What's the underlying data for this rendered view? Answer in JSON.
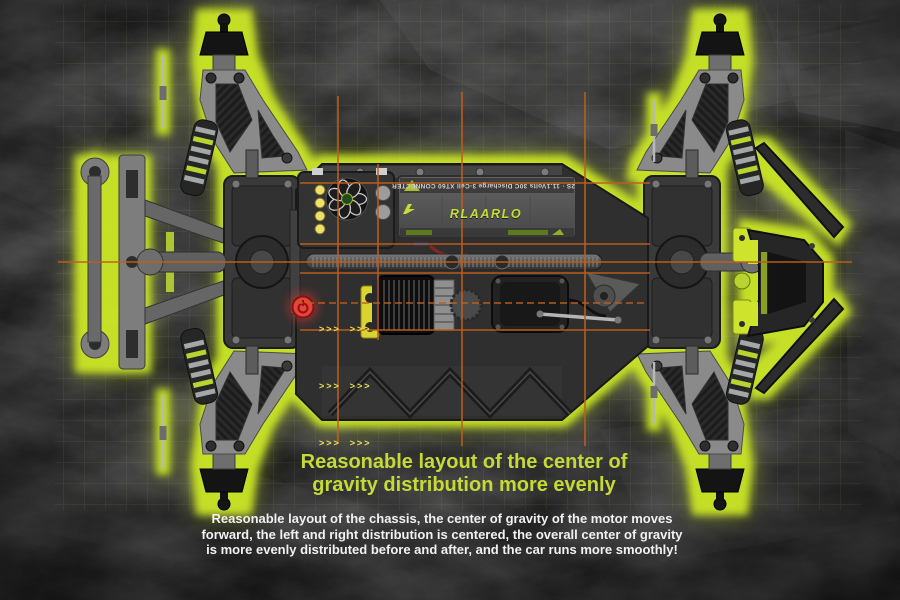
{
  "heading": {
    "line1": "Reasonable layout of the center of",
    "line2": "gravity distribution more evenly"
  },
  "body": {
    "line1": "Reasonable layout of the chassis, the center of gravity of the motor moves",
    "line2": "forward, the left and right distribution is centered, the overall center of gravity",
    "line3": "is more evenly distributed before and after, and the car runs more smoothly!"
  },
  "chassis": {
    "battery_brand": "RLAARLO",
    "battery_spec": "2S · 11.1Volts 30C Discharge 3-Cell XT60 CONNECTER",
    "arrow_rows": [
      ">>>  >>>",
      ">>>  >>>",
      ">>>  >>>"
    ]
  },
  "colors": {
    "glow_green": "#c9e426",
    "heading_green": "#c6da35",
    "orange_guide_line": "#bf5f1c",
    "power_button_red": "#e8423a",
    "accent_yellow": "#d9d42f",
    "body_text_white": "#f1f1f1"
  }
}
